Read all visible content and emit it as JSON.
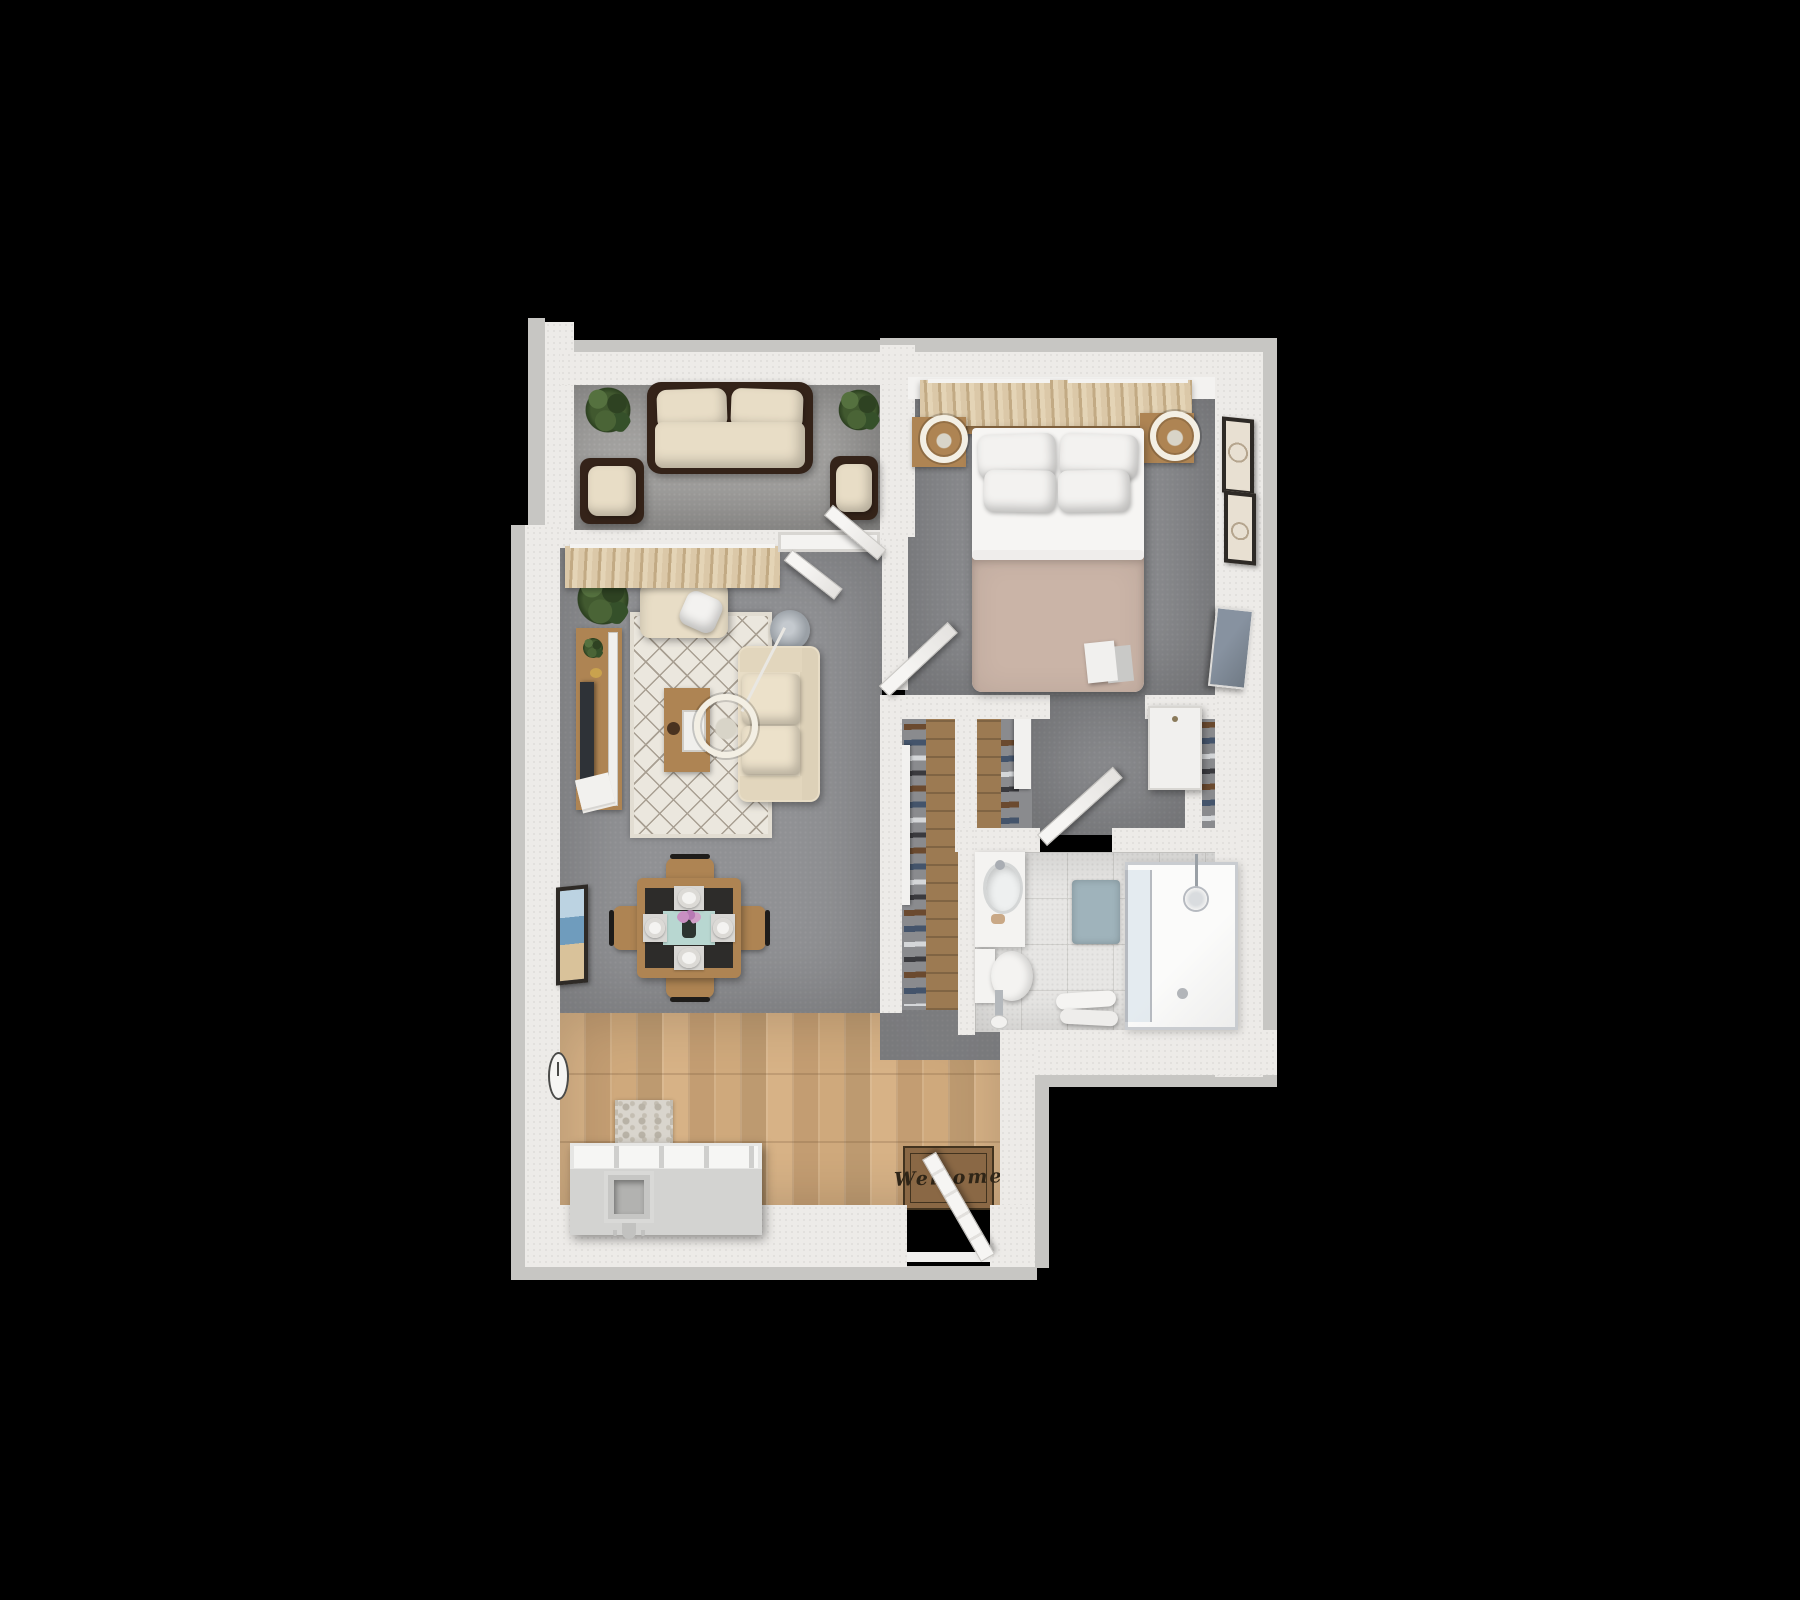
{
  "scene": {
    "type": "3d-floor-plan-render",
    "view": "top-down",
    "unit": "one-bedroom apartment",
    "background": "#000000"
  },
  "entry": {
    "mat_text": "Welcome"
  },
  "palette": {
    "bg": "#000000",
    "wall": "#edebe8",
    "wallOuter": "#c7c6c3",
    "concrete": "#a4a3a1",
    "carpetLiving": "#909194",
    "carpetBed": "#8a8b8e",
    "wood": "#cda87c",
    "closetWood": "#9c7a52",
    "tile": "#e7e6e4",
    "tileLine": "#d2d1ce",
    "rug": "#ebe7de",
    "rugLine": "#a89f92",
    "cream": "#e8ddc6",
    "wicker": "#342319",
    "furnWood": "#ae8453",
    "tableTop": "#2d2c2a",
    "teal": "#b8d7d1",
    "blanket": "#cab4a7",
    "sheet": "#f6f5f3",
    "pillow": "#f3f2f0",
    "curtA": "#dbc8a8",
    "curtB": "#c2aa84",
    "white": "#f5f4f2",
    "greyObj": "#9aa0a6",
    "tv": "#2e3237",
    "tvBed": "#707a85",
    "mat": "#8a6845",
    "matBorder": "#42331f",
    "matText": "#2f2517",
    "green": "#41592f"
  },
  "rooms": {
    "balcony": {
      "floor": "concrete",
      "furniture": [
        "wicker-sofa",
        "wicker-armchair",
        "wicker-armchair",
        "potted-plant",
        "potted-plant"
      ]
    },
    "living_room": {
      "floor": "grey-carpet",
      "furniture": [
        "curtains",
        "armchair",
        "throw-pillow",
        "area-rug",
        "media-console",
        "tv",
        "coffee-table",
        "arc-floor-lamp",
        "sofa",
        "dining-table",
        "dining-chairs-x4",
        "place-settings-x4",
        "flower-vase",
        "wall-art",
        "wall-clock",
        "potted-plant"
      ]
    },
    "bedroom": {
      "floor": "grey-carpet",
      "furniture": [
        "curtains",
        "double-bed",
        "pillows-x4",
        "headboard",
        "nightstand-x2",
        "ring-lamp-x2",
        "wall-art-x2",
        "wall-tv",
        "dresser",
        "book"
      ]
    },
    "closets": {
      "count": 3,
      "contents": [
        "hanging-clothes",
        "wood-shelf"
      ]
    },
    "bathroom": {
      "floor": "tile",
      "fixtures": [
        "vanity-sink",
        "toilet",
        "toilet-paper-stand",
        "bath-mat",
        "towels",
        "walk-in-shower",
        "shower-head"
      ]
    },
    "kitchen_entry": {
      "floor": "wood-planks",
      "furniture": [
        "kitchen-counter-sink",
        "small-rug",
        "welcome-mat",
        "entry-door"
      ]
    }
  }
}
